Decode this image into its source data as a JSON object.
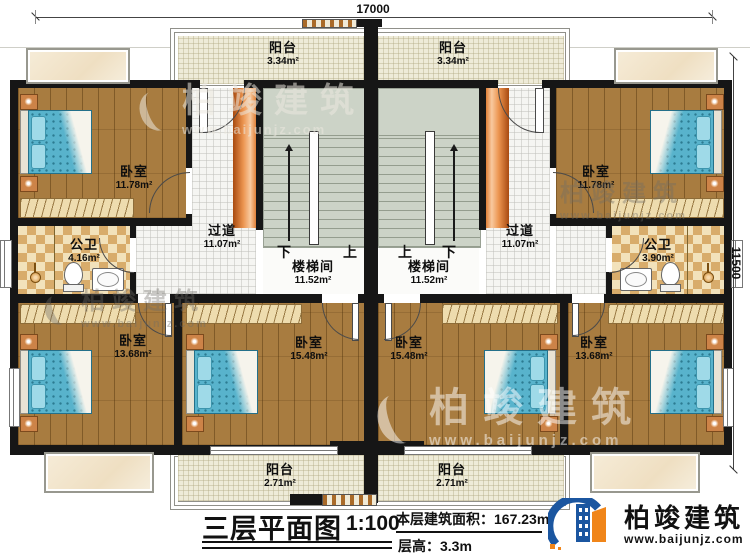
{
  "dimensions": {
    "width_label": "17000",
    "height_label": "11500"
  },
  "rooms": [
    {
      "id": "balcony-top-left",
      "label": "阳台",
      "area": "3.34m²"
    },
    {
      "id": "balcony-top-right",
      "label": "阳台",
      "area": "3.34m²"
    },
    {
      "id": "bedroom-upper-left",
      "label": "卧室",
      "area": "11.78m²"
    },
    {
      "id": "bedroom-upper-right",
      "label": "卧室",
      "area": "11.78m²"
    },
    {
      "id": "hallway-left",
      "label": "过道",
      "area": "11.07m²"
    },
    {
      "id": "hallway-right",
      "label": "过道",
      "area": "11.07m²"
    },
    {
      "id": "stairwell-left",
      "label": "楼梯间",
      "area": "11.52m²"
    },
    {
      "id": "stairwell-right",
      "label": "楼梯间",
      "area": "11.52m²"
    },
    {
      "id": "bathroom-left",
      "label": "公卫",
      "area": "4.16m²"
    },
    {
      "id": "bathroom-right",
      "label": "公卫",
      "area": "3.90m²"
    },
    {
      "id": "bedroom-bottom-left",
      "label": "卧室",
      "area": "13.68m²"
    },
    {
      "id": "bedroom-bottom-center-left",
      "label": "卧室",
      "area": "15.48m²"
    },
    {
      "id": "bedroom-bottom-center-right",
      "label": "卧室",
      "area": "15.48m²"
    },
    {
      "id": "bedroom-bottom-right",
      "label": "卧室",
      "area": "13.68m²"
    },
    {
      "id": "balcony-bottom-left",
      "label": "阳台",
      "area": "2.71m²"
    },
    {
      "id": "balcony-bottom-right",
      "label": "阳台",
      "area": "2.71m²"
    }
  ],
  "stairs": {
    "left": {
      "down": "下",
      "up": "上"
    },
    "right": {
      "up": "上",
      "down": "下"
    }
  },
  "title_block": {
    "title": "三层平面图",
    "scale": "1:100",
    "area_label": "本层建筑面积：",
    "area_value": "167.23m²",
    "floor_height_label": "层高：",
    "floor_height_value": "3.3m"
  },
  "brand": {
    "name": "柏竣建筑",
    "url": "www.baijunjz.com"
  },
  "colors": {
    "wall": "#161616",
    "wood_floor": "#a87c40",
    "stair": "#ccd3c7",
    "balcony": "#eeebd8",
    "tile_dark": "#d8ac6b",
    "tile_light": "#f2e2bb",
    "brand_blue": "#1b56a0",
    "brand_orange": "#f08519",
    "duct_orange": "#ec9550"
  }
}
